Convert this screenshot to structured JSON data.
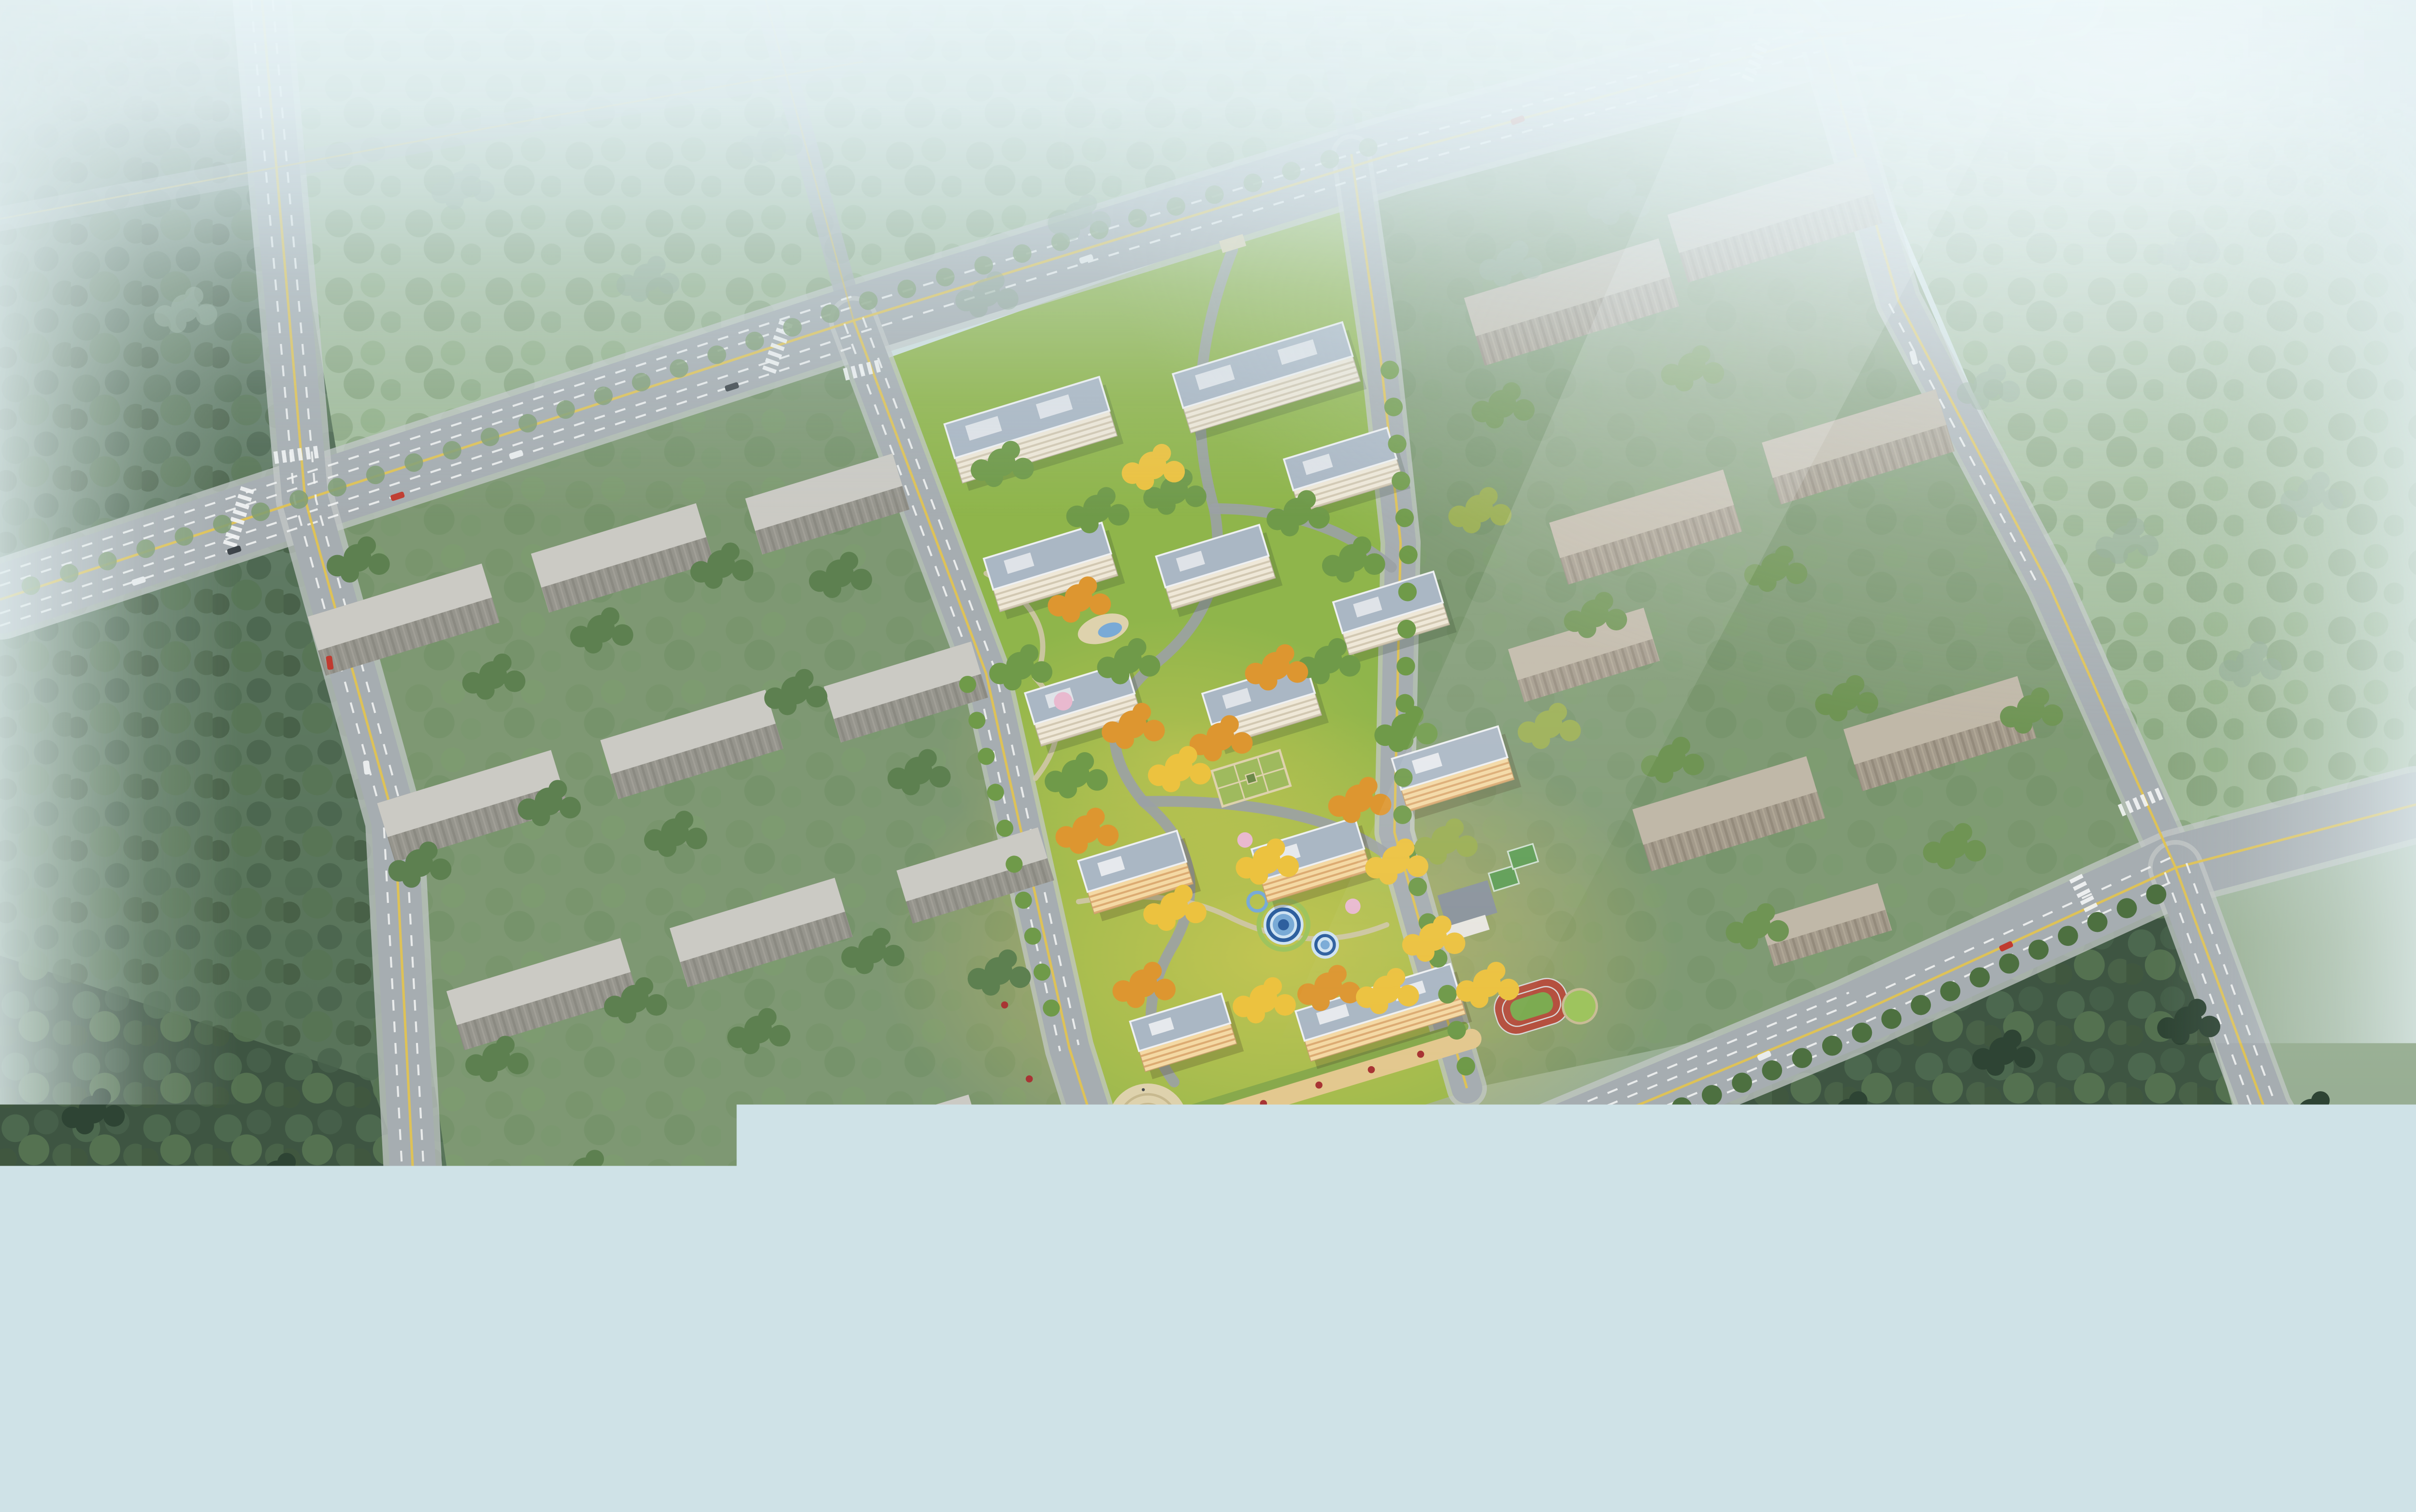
{
  "scene": {
    "kind": "architectural-aerial-rendering",
    "subject": "residential-development-masterplan-birdseye",
    "atmosphere": "hazy-daylight-fog-top",
    "visible_text": "none",
    "counts": {
      "residential_towers": 13,
      "context_massing_buildings": 19,
      "road_intersections": 6,
      "cars": 19
    },
    "features": [
      "road-grid",
      "central-compound",
      "entrance-plaza",
      "sculpture",
      "circular-pools",
      "playground",
      "formal-garden",
      "kindergarten-courts",
      "running-track",
      "retail-podium",
      "context-blocks",
      "forest-bottom-left",
      "forest-bottom-right",
      "hazy-forest-top"
    ]
  },
  "palette": {
    "fog_top": "#e8f4f6",
    "fog_mid": "#cfe2e7",
    "field": "#7e9873",
    "field2": "#7f9a74",
    "topfield": "#9db894",
    "forest_dark": "#3e5542",
    "forest_mid": "#4e6a50",
    "lawn": "#8fb54b",
    "lawn_sun": "#c3cc55",
    "road": "#a6adb1",
    "road_haze": "#bcc6c8",
    "lane": "#f4f6f6",
    "center_yellow": "#e0c352",
    "massing_roof": "#cbcac4",
    "massing_face": "#95948d",
    "massing_warm_roof": "#c0b8a8",
    "massing_warm_face": "#9b9284",
    "tower_roof": "#aab7c4",
    "tower_roof_trim": "#eef0f2",
    "tower_face": "#efe8d8",
    "tower_accent": "#7a6a52",
    "tower_warm_face": "#f3d49b",
    "autumn_orange": "#dd9630",
    "autumn_yellow": "#ecc23f",
    "tree_green": "#6f9a49",
    "tree_dark": "#4d7040",
    "tree_haze": "#8aa58f",
    "blossom_pink": "#e9b9cf",
    "pool_blue": "#2e5f9e",
    "pool_light": "#79aad6",
    "pool_pale": "#cfe3f2",
    "track_red": "#b5503f",
    "court_green": "#5f9e55",
    "infield": "#7cab51",
    "plaza": "#ded2ad",
    "plaza_ring": "#c7b98f",
    "sculpture": "#d63c6e",
    "retail_warm": "#e3c88f",
    "green_roof": "#86a84c",
    "umbrella_red": "#a83434",
    "car_red": "#c03b30",
    "car_white": "#e9eced",
    "car_dark": "#3c4348"
  }
}
